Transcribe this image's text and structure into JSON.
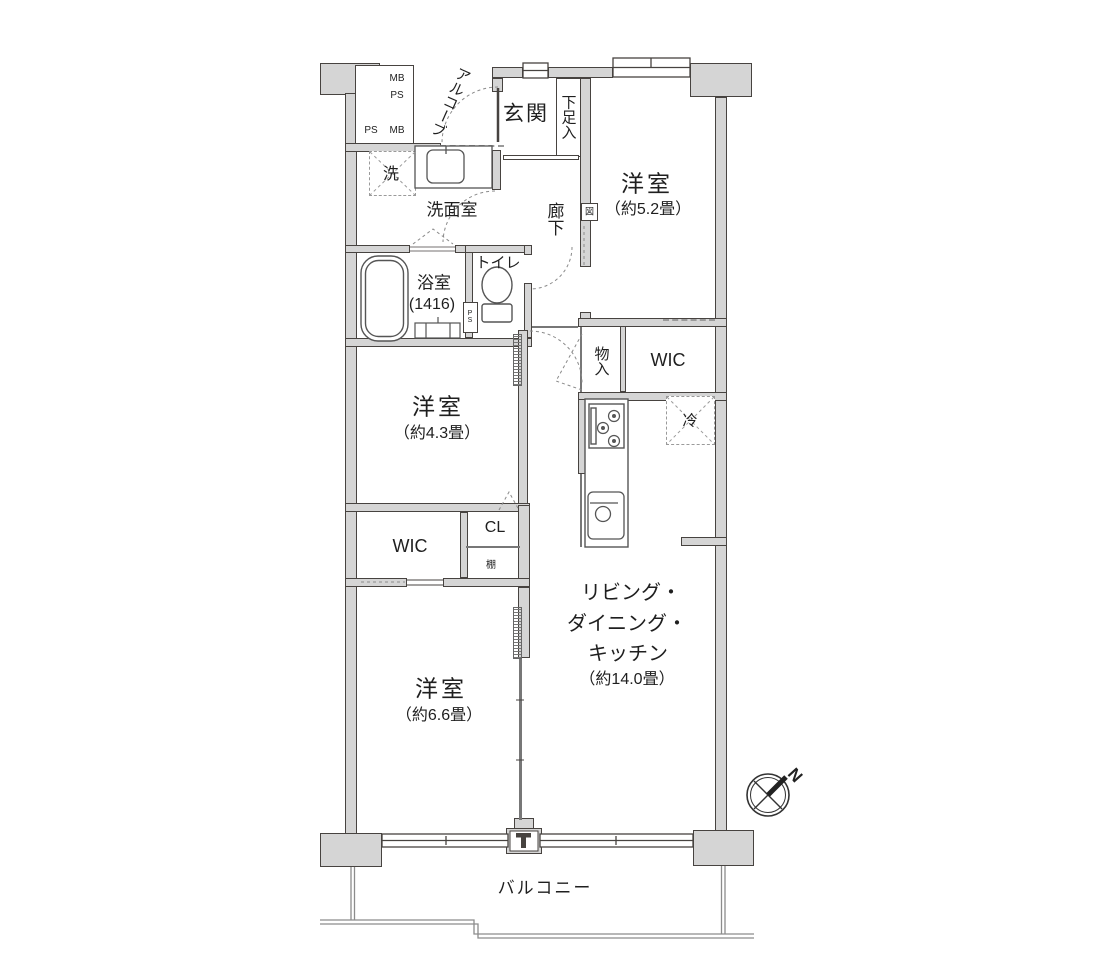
{
  "title": "マンション間取り図 3LDK",
  "colors": {
    "bg": "#ffffff",
    "wall_fill": "#d5d5d5",
    "wall_stroke": "#474340",
    "dash": "#9a9a9a",
    "text": "#1f1f1f"
  },
  "labels": {
    "alcove": "アルコーブ",
    "mb1": "MB",
    "ps1": "PS",
    "ps2": "PS",
    "mb2": "MB",
    "entrance": "玄関",
    "shoe": "下足入",
    "hallway": "廊下",
    "panel": "図",
    "room52": "洋室",
    "room52_size": "（約5.2畳）",
    "washroom": "洗面室",
    "washer": "洗",
    "bath": "浴室",
    "bath_size": "(1416)",
    "toilet": "トイレ",
    "ps_duct": "PS",
    "monoire": "物入",
    "wic_top": "WIC",
    "fridge": "冷",
    "room43": "洋室",
    "room43_size": "（約4.3畳）",
    "cl": "CL",
    "shelf": "棚",
    "wic_bottom": "WIC",
    "room66": "洋室",
    "room66_size": "（約6.6畳）",
    "ldk1": "リビング・",
    "ldk2": "ダイニング・",
    "ldk3": "キッチン",
    "ldk4": "（約14.0畳）",
    "balcony": "バルコニー",
    "compass_n": "N"
  },
  "rooms": [
    {
      "name": "玄関"
    },
    {
      "name": "洋室",
      "size": "約5.2畳"
    },
    {
      "name": "洗面室"
    },
    {
      "name": "浴室",
      "size": "1416"
    },
    {
      "name": "トイレ"
    },
    {
      "name": "洋室",
      "size": "約4.3畳"
    },
    {
      "name": "物入"
    },
    {
      "name": "WIC"
    },
    {
      "name": "CL"
    },
    {
      "name": "WIC"
    },
    {
      "name": "洋室",
      "size": "約6.6畳"
    },
    {
      "name": "リビング・ダイニング・キッチン",
      "size": "約14.0畳"
    },
    {
      "name": "バルコニー"
    }
  ]
}
